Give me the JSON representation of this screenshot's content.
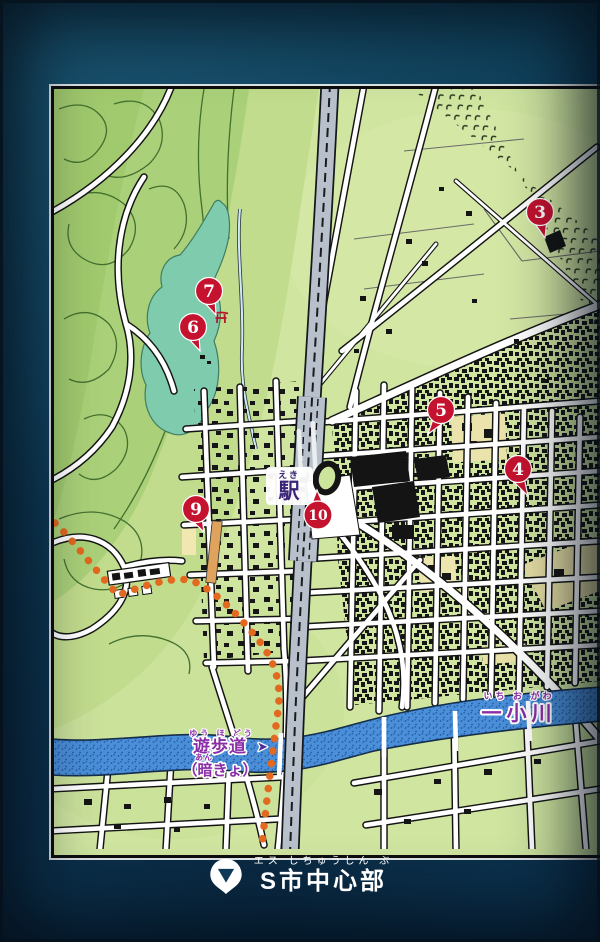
{
  "map": {
    "station": {
      "furigana": "えき",
      "label": "駅"
    },
    "river": {
      "furigana": "いち お がわ",
      "label": "一小川"
    },
    "promenade": {
      "furigana": "ゆう ほ どう",
      "label": "遊歩道",
      "arrow": "➤"
    },
    "culvert": {
      "furigana": "あん",
      "label": "（暗きょ）"
    },
    "markers": [
      "3",
      "4",
      "5",
      "6",
      "7",
      "9",
      "10"
    ]
  },
  "caption": {
    "furigana": "エス しちゅうしん ぶ",
    "label": "S市中心部"
  },
  "colors": {
    "marker_red": "#c5122f",
    "path_orange": "#e2691f",
    "highlight_road_orange": "#dfa35e",
    "river_blue": "#4a8fd8",
    "lake_teal": "#7fcbad",
    "label_purple": "#8a2da6",
    "station_purple": "#3a2578",
    "map_green": "#cfe5a0",
    "forest_green": "#aad179",
    "rail_gray": "#b7c0cb",
    "bg_navy": "#0e3d5a"
  }
}
